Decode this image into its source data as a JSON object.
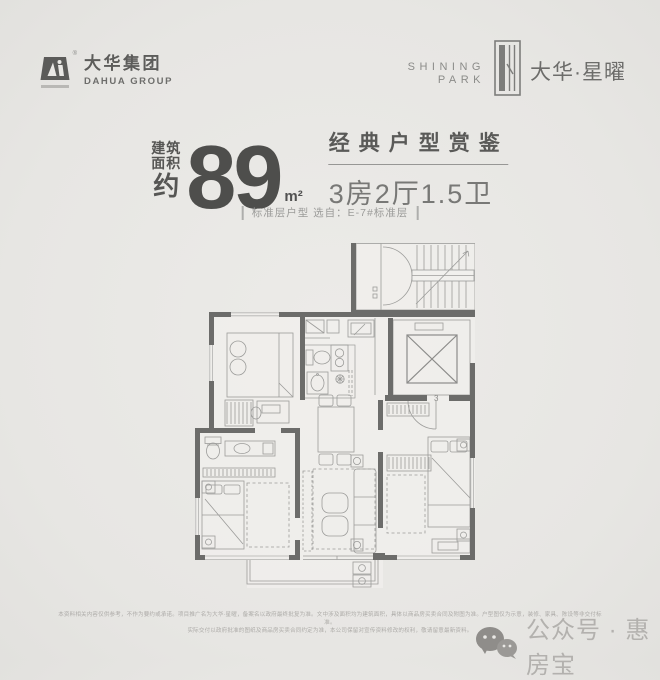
{
  "colors": {
    "background": "#e8e7e4",
    "wall": "#6c6c6a",
    "plan_line": "#9c9c9a",
    "ink_dark": "#4e4e4c",
    "ink_mid": "#5a5a58",
    "muted": "#9b9b99",
    "watermark": "#b3b1ae"
  },
  "header": {
    "dahua": {
      "name_cn": "大华集团",
      "name_en": "DAHUA GROUP",
      "registered_mark": "®"
    },
    "project": {
      "en_top": "SHINING",
      "en_bottom": "PARK",
      "name_cn": "大华·星曜"
    }
  },
  "headline": {
    "area_label_1": "建筑",
    "area_label_2": "面积",
    "area_label_3": "约",
    "area_value": "89",
    "area_unit": "m²",
    "series_title": "经典户型赏鉴",
    "layout_spec": "3房2厅1.5卫",
    "subtitle": "标准层户型  选自：E-7#标准层"
  },
  "floorplan": {
    "entry_label": "3"
  },
  "footer": {
    "disclaimer_line1": "本资料相关内容仅供参考，不作为要约或承诺。项目推广名为大华·星曜，备案名以政府最终批复为准。文中涉及面积均为建筑面积，具体以商品房买卖合同及附图为准。户型图仅为示意，装修、家具、陈设等非交付标准。",
    "disclaimer_line2": "实际交付以政府批准的图纸及商品房买卖合同约定为准，本公司保留对宣传资料修改的权利，敬请留意最新资料。",
    "watermark": "公众号 · 惠房宝"
  }
}
